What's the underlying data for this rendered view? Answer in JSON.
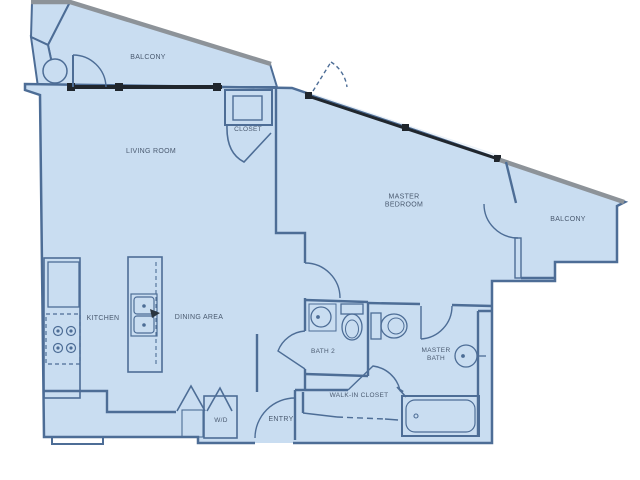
{
  "figure": {
    "type": "apartment-floor-plan",
    "background": "#ffffff"
  },
  "palette": {
    "room_fill": "#c9ddf1",
    "wall_line": "#4d6d96",
    "balcony_edge": "#8d9399",
    "glazing": "#20262d",
    "label_text": "#4a5a70"
  },
  "labels": {
    "balcony_top": {
      "text": "BALCONY"
    },
    "living_room": {
      "text": "LIVING ROOM"
    },
    "closet": {
      "text": "CLOSET"
    },
    "master_bedroom": {
      "text": "MASTER BEDROOM"
    },
    "balcony_right": {
      "text": "BALCONY"
    },
    "kitchen": {
      "text": "KITCHEN"
    },
    "dining_area": {
      "text": "DINING AREA"
    },
    "bath_2": {
      "text": "BATH 2"
    },
    "master_bath": {
      "text": "MASTER BATH"
    },
    "walk_in_closet": {
      "text": "WALK-IN CLOSET"
    },
    "wd": {
      "text": "W/D"
    },
    "entry": {
      "text": "ENTRY"
    }
  },
  "fixtures": {
    "names": [
      "balcony-table",
      "balcony-door-swing",
      "sliding-glass-window",
      "closet-shelf",
      "closet-door-swing",
      "bedroom-window",
      "bedroom-door-swing",
      "balcony-door",
      "refrigerator",
      "range-burners",
      "kitchen-counter",
      "island-sink",
      "washer-dryer",
      "bifold-doors",
      "entry-door-swing",
      "bath2-vanity-sink",
      "bath2-toilet",
      "masterbath-toilet",
      "masterbath-sink",
      "bathtub",
      "closet-rod-dashed",
      "walkin-door-swing",
      "masterbath-door-swing"
    ]
  }
}
